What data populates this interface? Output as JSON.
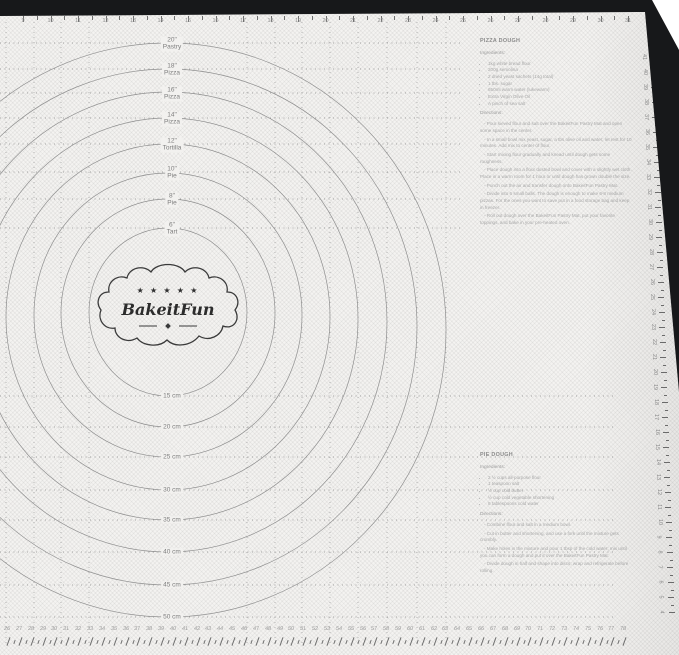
{
  "brand": {
    "stars": "★ ★ ★ ★ ★",
    "logo_text": "BakeitFun"
  },
  "circles": [
    {
      "inch": "6\"",
      "name": "Tart",
      "cm": "15 cm"
    },
    {
      "inch": "8\"",
      "name": "Pie",
      "cm": "20 cm"
    },
    {
      "inch": "10\"",
      "name": "Pie",
      "cm": "25 cm"
    },
    {
      "inch": "12\"",
      "name": "Tortilla",
      "cm": "30 cm"
    },
    {
      "inch": "14\"",
      "name": "Pizza",
      "cm": "35 cm"
    },
    {
      "inch": "16\"",
      "name": "Pizza",
      "cm": "40 cm"
    },
    {
      "inch": "18\"",
      "name": "Pizza",
      "cm": "45 cm"
    },
    {
      "inch": "20\"",
      "name": "Pastry",
      "cm": "50 cm"
    }
  ],
  "rulers": {
    "top_inches": {
      "start": 9,
      "end": 31
    },
    "bottom_cm": {
      "start": 26,
      "end": 78
    },
    "right_cm": {
      "start": 41,
      "end": 4
    }
  },
  "recipes": {
    "pizza": {
      "title": "PIZZA DOUGH",
      "ingredients_heading": "Ingredients:",
      "ingredients": [
        "1kg white bread flour",
        "200g semolina",
        "2 dried yeast sachets (14g total)",
        "1 tbs. sugar",
        "650ml warm water (lukewarm)",
        "Extra Virgin Olive Oil",
        "A pinch of sea salt"
      ],
      "directions_heading": "Directions:",
      "directions": [
        "- Pour sieved flour and salt over the BakeitFun Pastry Mat and open some space in the center.",
        "- In a small bowl mix yeast, sugar, a tbs olive oil and water; let rest for 10 minutes. Add mix to center of flour.",
        "- Start mixing flour gradually and knead until dough gets some roughness.",
        "- Place dough into a flour dusted bowl and cover with a slightly wet cloth. Place in a warm room for 1 hour or until dough has grown double the size.",
        "- Punch out the air and transfer dough onto BakeitFun Pastry Mat.",
        "- Divide into 6 small balls. The dough is enough to make 6-8 medium pizzas. For the ones you want to save put in a food storage bag and keep in freezer.",
        "- Roll out dough over the BakeitFun Pastry Mat, put your favorite toppings, and bake in your pre-heated oven."
      ]
    },
    "pie": {
      "title": "PIE DOUGH",
      "ingredients_heading": "Ingredients:",
      "ingredients": [
        "2 ½ cups all-purpose flour",
        "1 teaspoon salt",
        "½ cup cold butter",
        "½ cup cold vegetable shortening",
        "8 tablespoons cold water"
      ],
      "directions_heading": "Directions:",
      "directions": [
        "- Combine flour and salt in a medium bowl.",
        "- Cut in butter and shortening, and use a fork until the mixture gets crumbly.",
        "- Make holes in the mixture and pour 1 tbsp of the cold water; mix until you can form a dough and put it over the BakeitFun Pastry Mat.",
        "- Divide dough in half and shape into discs; wrap and refrigerate before rolling."
      ]
    }
  },
  "colors": {
    "mat_base": "#f2f1ef",
    "border_black": "#17181a",
    "guide_line": "#8f8f8f",
    "label_text": "#7d7d7d",
    "recipe_text": "#a9a9a9"
  }
}
